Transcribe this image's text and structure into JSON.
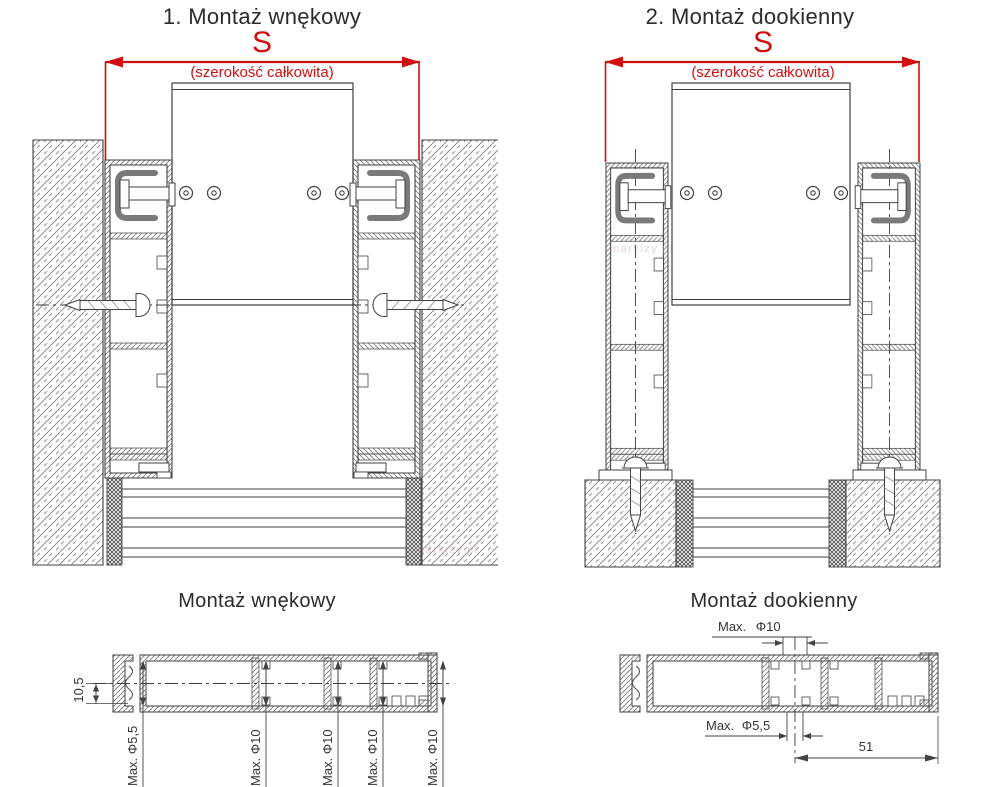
{
  "colors": {
    "accent_red": "#d01010",
    "line": "#424242",
    "text": "#2b2b2b"
  },
  "sections": {
    "top_left": {
      "title": "1. Montaż wnękowy",
      "dim_label": "S",
      "dim_sublabel": "(szerokość całkowita)"
    },
    "top_right": {
      "title": "2. Montaż dookienny",
      "dim_label": "S",
      "dim_sublabel": "(szerokość całkowita)"
    },
    "bottom_left": {
      "title": "Montaż wnękowy",
      "height_dim": "10,5",
      "hole_labels": [
        "Max. Φ5,5",
        "Max. Φ10",
        "Max. Φ10",
        "Max. Φ10",
        "Max. Φ10"
      ]
    },
    "bottom_right": {
      "title": "Montaż dookienny",
      "top_hole_label": "Max. Φ10",
      "bottom_hole_label": "Max. Φ5,5",
      "width_dim": "51"
    },
    "watermark": "markizy.pl"
  }
}
